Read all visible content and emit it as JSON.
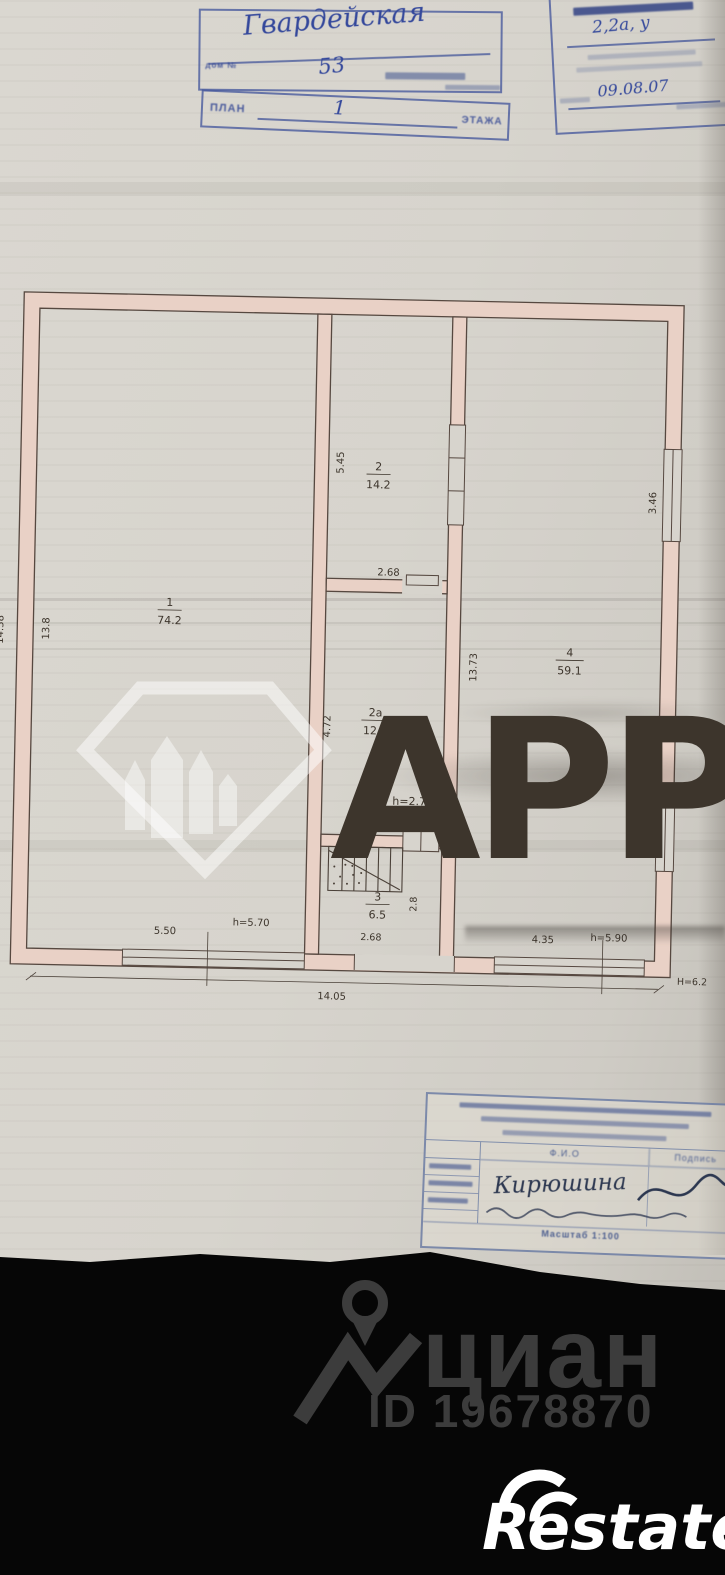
{
  "stamps": {
    "address": {
      "street": "Гвардейская",
      "house_label": "дом №",
      "house_number": "53",
      "plan_label": "ПЛАН",
      "floor_number": "1",
      "floor_label": "ЭТАЖА"
    },
    "registry": {
      "object_value": "2,2а, у",
      "date": "09.08.07"
    }
  },
  "plan": {
    "rooms": [
      {
        "number": "1",
        "area": "74.2"
      },
      {
        "number": "2",
        "area": "14.2"
      },
      {
        "number": "2а",
        "area": "12.3"
      },
      {
        "number": "3",
        "area": "6.5"
      },
      {
        "number": "4",
        "area": "59.1"
      }
    ],
    "dims": {
      "left_outer": "14.38",
      "left_inner": "13.8",
      "room2_height": "5.45",
      "room2_width": "2.68",
      "room2a_height": "4.72",
      "ceiling_h": "h=2.70",
      "opening": "0.60",
      "room3_height": "2.8",
      "room3_width": "2.68",
      "room4_height": "13.73",
      "win_right_top": "3.46",
      "win_right_bottom": "3.46",
      "bottom_left": "5.50",
      "bottom_left_h": "h=5.70",
      "bottom_right": "4.35",
      "bottom_right_h": "h=5.90",
      "total_width": "14.05",
      "building_height": "Н=6.2"
    }
  },
  "watermark": {
    "text": "АРР"
  },
  "title_block": {
    "fio_header": "Ф.И.О",
    "signature_header": "Подпись",
    "executor_name": "Кирюшина",
    "scale": "Масштаб 1:100"
  },
  "footer": {
    "cian_wordmark": "циан",
    "listing_id": "ID 19678870",
    "restate_wordmark": "Restate"
  }
}
